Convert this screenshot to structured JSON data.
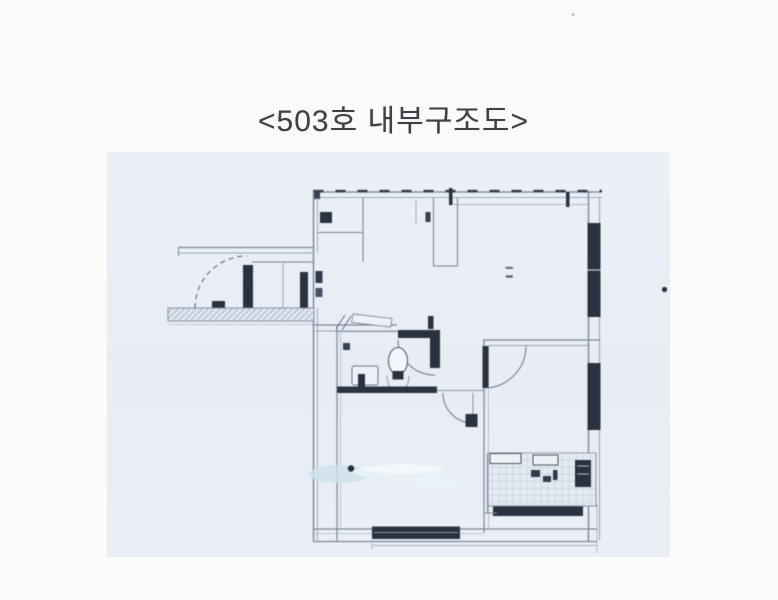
{
  "page": {
    "background": "#fbfbfc"
  },
  "caption": {
    "text": "<503호 내부구조도>",
    "color": "#3e4147"
  },
  "scan": {
    "background": "#e9eef5",
    "ink_color": "#7c8699",
    "dark_ink_color": "#2a3240",
    "smudge_color": "#d9e8f2",
    "room_label": {
      "line1": "▪▪▪▪",
      "line2": "▪▪▪"
    }
  }
}
